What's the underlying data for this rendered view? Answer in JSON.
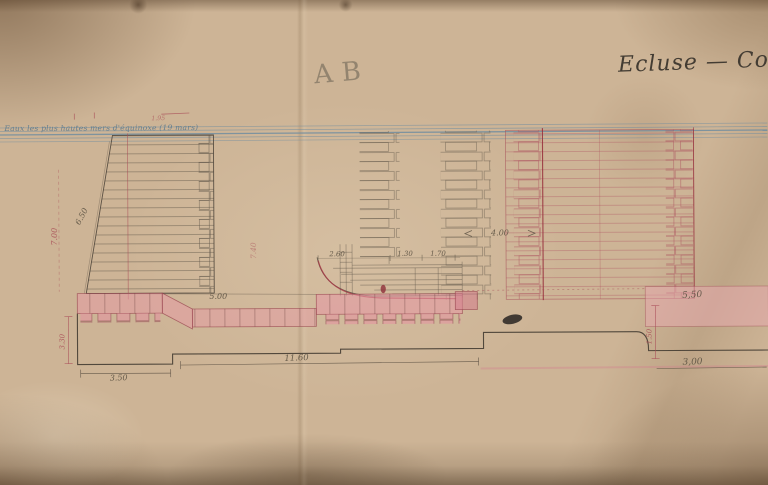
{
  "sheet": {
    "title_script": "Ecluse — Cou",
    "section_mark_pencil": "AB",
    "waterline_note_blue": "Eaux les plus hautes mers d'équinoxe (19 mars)"
  },
  "dimensions": {
    "ramp_a": "2.60",
    "ramp_b": "1.30",
    "ramp_c": "1.70",
    "floor_mid": "5.00",
    "pier_gap": "4.00",
    "right_slab": "5,50",
    "bottom_left": "3.50",
    "bottom_mid": "11.60",
    "bottom_right": "3,00",
    "left_slope_pencil": "6.50",
    "left_height_red": "7.00",
    "left_depth_red": "3.30",
    "mid_height_red": "7.40",
    "right_depth_red": "1.50",
    "waterline_red": "1.95"
  },
  "colors": {
    "paper": "#cdb496",
    "pencil": "#6f665a",
    "red_ink": "#a84a55",
    "pink_wash": "#e59aa4",
    "water_blue": "#6b8ba1",
    "title_ink": "#43b3c33"
  }
}
